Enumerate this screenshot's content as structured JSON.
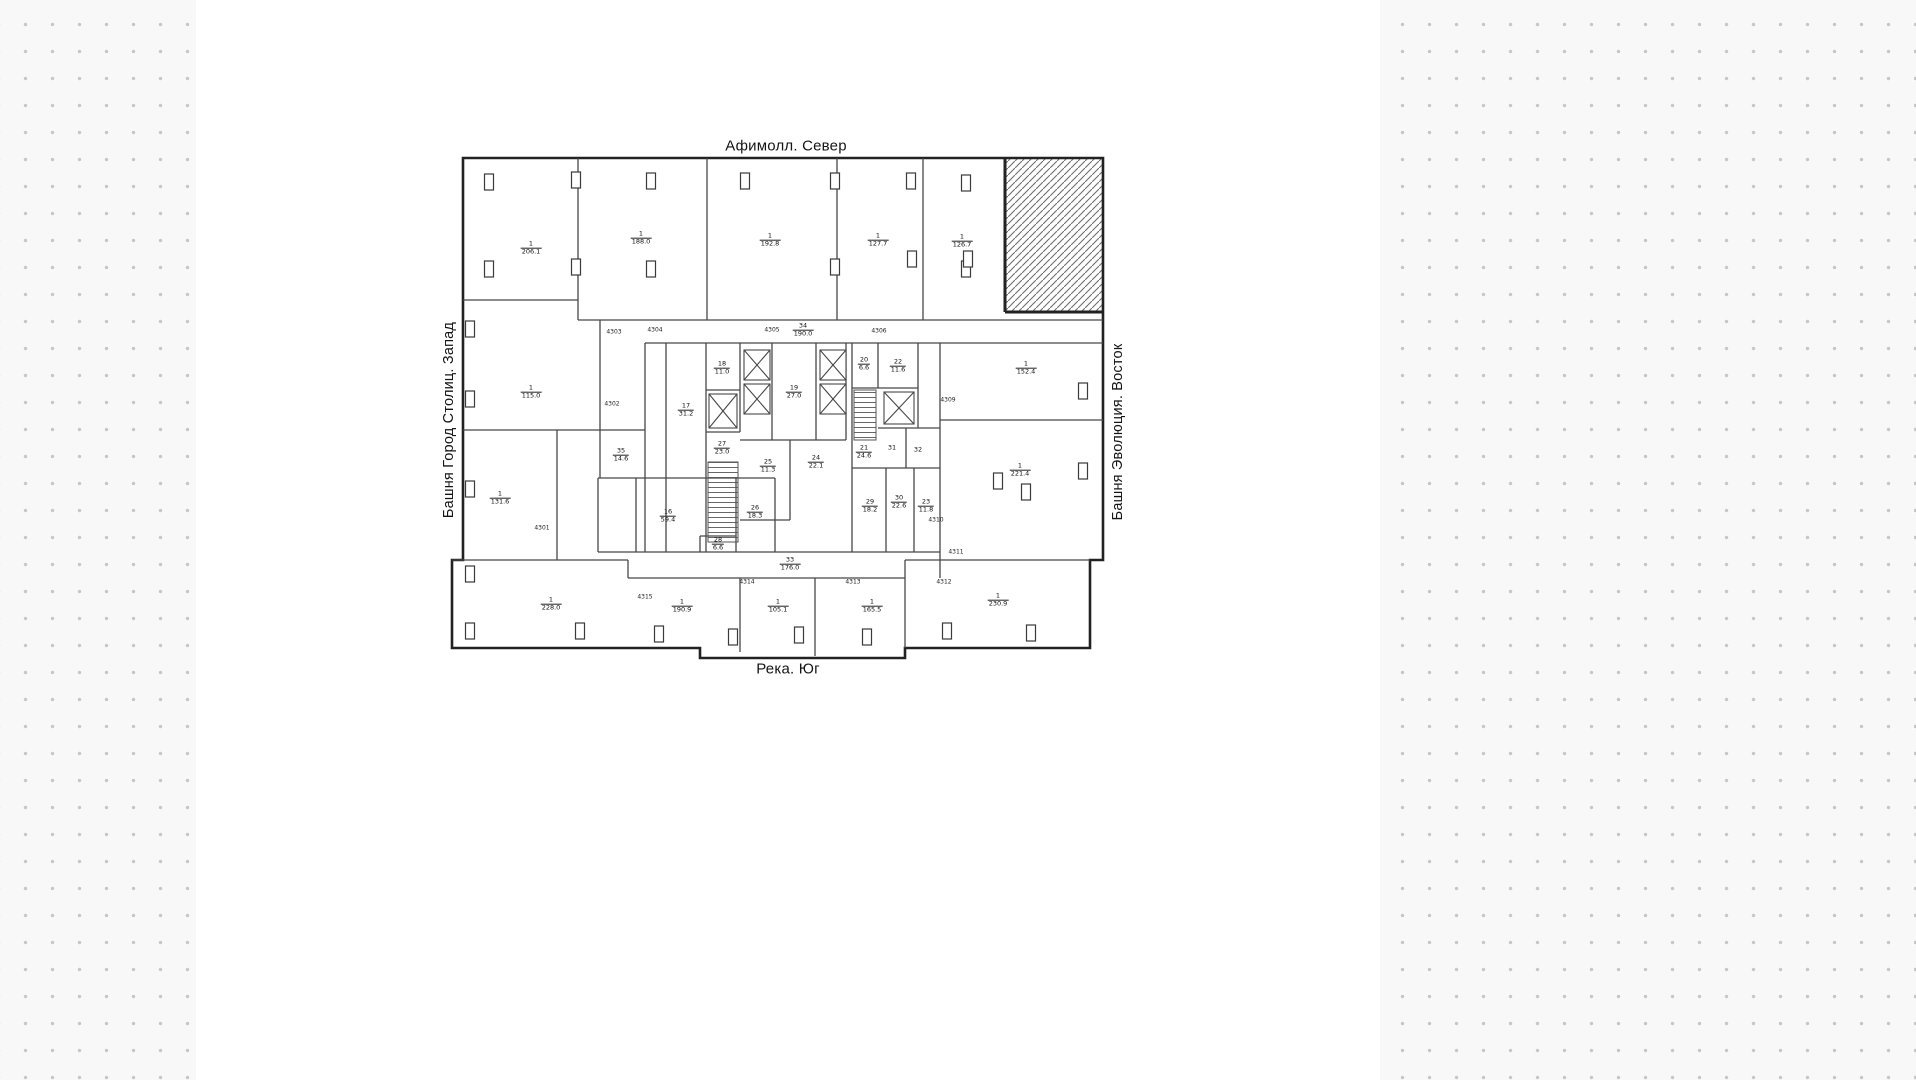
{
  "compass": {
    "north": "Афимолл. Север",
    "south": "Река. Юг",
    "west": "Башня Город Столиц. Запад",
    "east": "Башня Эволюция. Восток"
  },
  "rooms": [
    {
      "num": "1",
      "area": "206.1",
      "x": 531,
      "y": 248
    },
    {
      "num": "1",
      "area": "188.0",
      "x": 641,
      "y": 238
    },
    {
      "num": "1",
      "area": "192.8",
      "x": 770,
      "y": 240
    },
    {
      "num": "1",
      "area": "127.7",
      "x": 878,
      "y": 240
    },
    {
      "num": "1",
      "area": "126.7",
      "x": 962,
      "y": 241
    },
    {
      "num": "1",
      "area": "115.0",
      "x": 531,
      "y": 392
    },
    {
      "num": "1",
      "area": "131.6",
      "x": 500,
      "y": 498
    },
    {
      "num": "1",
      "area": "152.4",
      "x": 1026,
      "y": 368
    },
    {
      "num": "1",
      "area": "221.4",
      "x": 1020,
      "y": 470
    },
    {
      "num": "1",
      "area": "228.0",
      "x": 551,
      "y": 604
    },
    {
      "num": "1",
      "area": "190.9",
      "x": 682,
      "y": 606
    },
    {
      "num": "1",
      "area": "105.1",
      "x": 778,
      "y": 606
    },
    {
      "num": "1",
      "area": "165.5",
      "x": 872,
      "y": 606
    },
    {
      "num": "1",
      "area": "230.9",
      "x": 998,
      "y": 600
    },
    {
      "num": "35",
      "area": "14.6",
      "x": 621,
      "y": 455
    },
    {
      "num": "16",
      "area": "59.4",
      "x": 668,
      "y": 516
    },
    {
      "num": "26",
      "area": "18.3",
      "x": 755,
      "y": 512
    },
    {
      "num": "28",
      "area": "6.6",
      "x": 718,
      "y": 544
    },
    {
      "num": "17",
      "area": "31.2",
      "x": 686,
      "y": 410
    },
    {
      "num": "18",
      "area": "11.0",
      "x": 722,
      "y": 368
    },
    {
      "num": "27",
      "area": "23.0",
      "x": 722,
      "y": 448
    },
    {
      "num": "19",
      "area": "27.0",
      "x": 794,
      "y": 392
    },
    {
      "num": "25",
      "area": "11.3",
      "x": 768,
      "y": 466
    },
    {
      "num": "24",
      "area": "22.1",
      "x": 816,
      "y": 462
    },
    {
      "num": "20",
      "area": "6.6",
      "x": 864,
      "y": 364
    },
    {
      "num": "22",
      "area": "11.6",
      "x": 898,
      "y": 366
    },
    {
      "num": "21",
      "area": "24.6",
      "x": 864,
      "y": 452
    },
    {
      "num": "31",
      "area": "",
      "x": 892,
      "y": 448
    },
    {
      "num": "32",
      "area": "",
      "x": 918,
      "y": 450
    },
    {
      "num": "29",
      "area": "18.2",
      "x": 870,
      "y": 506
    },
    {
      "num": "30",
      "area": "22.6",
      "x": 899,
      "y": 502
    },
    {
      "num": "23",
      "area": "11.8",
      "x": 926,
      "y": 506
    },
    {
      "num": "33",
      "area": "176.0",
      "x": 790,
      "y": 564
    },
    {
      "num": "34",
      "area": "190.0",
      "x": 803,
      "y": 330
    }
  ],
  "marks": [
    {
      "text": "4301",
      "x": 542,
      "y": 528
    },
    {
      "text": "4302",
      "x": 612,
      "y": 404
    },
    {
      "text": "4303",
      "x": 614,
      "y": 332
    },
    {
      "text": "4304",
      "x": 655,
      "y": 330
    },
    {
      "text": "4305",
      "x": 772,
      "y": 330
    },
    {
      "text": "4306",
      "x": 879,
      "y": 331
    },
    {
      "text": "4309",
      "x": 948,
      "y": 400
    },
    {
      "text": "4310",
      "x": 936,
      "y": 520
    },
    {
      "text": "4311",
      "x": 956,
      "y": 552
    },
    {
      "text": "4312",
      "x": 944,
      "y": 582
    },
    {
      "text": "4313",
      "x": 853,
      "y": 582
    },
    {
      "text": "4314",
      "x": 747,
      "y": 582
    },
    {
      "text": "4315",
      "x": 645,
      "y": 597
    }
  ],
  "colors": {
    "outer_wall": "#222222",
    "inner_wall": "#474747",
    "hatch": "#6e6e6e",
    "dot": "#c7c7c7",
    "sheet": "#ffffff"
  }
}
